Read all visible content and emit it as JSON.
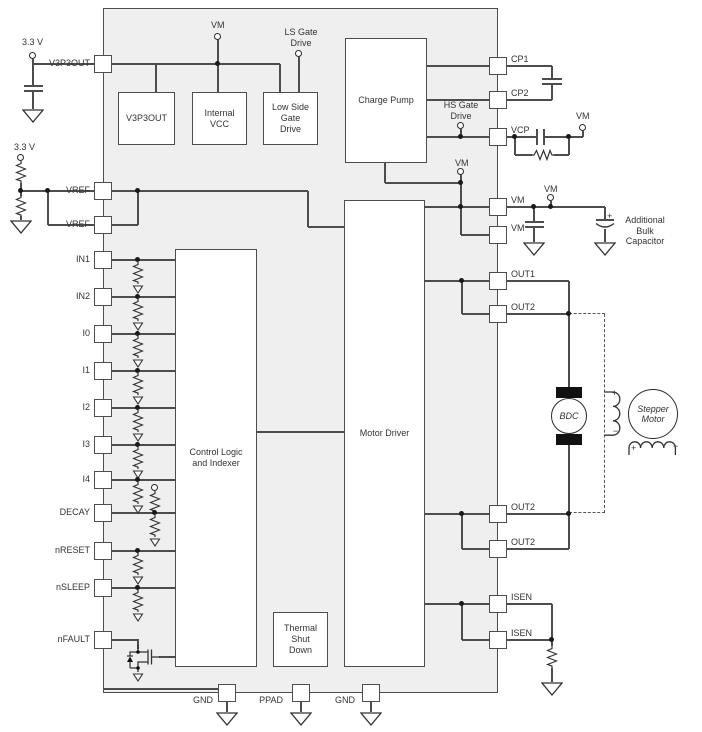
{
  "title": "Motor driver functional block diagram",
  "supplies": {
    "v3p3_top": "3.3 V",
    "v3p3_vref": "3.3 V"
  },
  "terminals": {
    "vm": "VM",
    "ls_gate": [
      "LS Gate",
      "Drive"
    ],
    "hs_gate": [
      "HS Gate",
      "Drive"
    ]
  },
  "blocks": {
    "v3p3out": [
      "V3P3OUT"
    ],
    "internal_vcc": [
      "Internal",
      "VCC"
    ],
    "low_side_gate_drive": [
      "Low Side",
      "Gate",
      "Drive"
    ],
    "charge_pump": [
      "Charge Pump"
    ],
    "control_logic": [
      "Control Logic",
      "and Indexer"
    ],
    "motor_driver": [
      "Motor Driver"
    ],
    "thermal_shutdown": [
      "Thermal",
      "Shut",
      "Down"
    ]
  },
  "pins": {
    "left": [
      "V3P3OUT",
      "VREF",
      "VREF",
      "IN1",
      "IN2",
      "I0",
      "I1",
      "I2",
      "I3",
      "I4",
      "DECAY",
      "nRESET",
      "nSLEEP",
      "nFAULT"
    ],
    "right": [
      "CP1",
      "CP2",
      "VCP",
      "VM",
      "VM",
      "OUT1",
      "OUT2",
      "OUT2",
      "OUT2",
      "ISEN",
      "ISEN"
    ],
    "bottom": [
      "GND",
      "PPAD",
      "GND"
    ]
  },
  "external": {
    "additional_bulk_cap": [
      "Additional",
      "Bulk",
      "Capacitor"
    ],
    "bulk_cap_plus": "+",
    "bdc_motor": "BDC",
    "stepper_motor": [
      "Stepper",
      "Motor"
    ],
    "plus": "+",
    "minus": "−"
  },
  "colors": {
    "chip_fill": "#efefef",
    "wire": "#4d4d4d",
    "text": "#333333",
    "component": "#2b2b2b"
  }
}
